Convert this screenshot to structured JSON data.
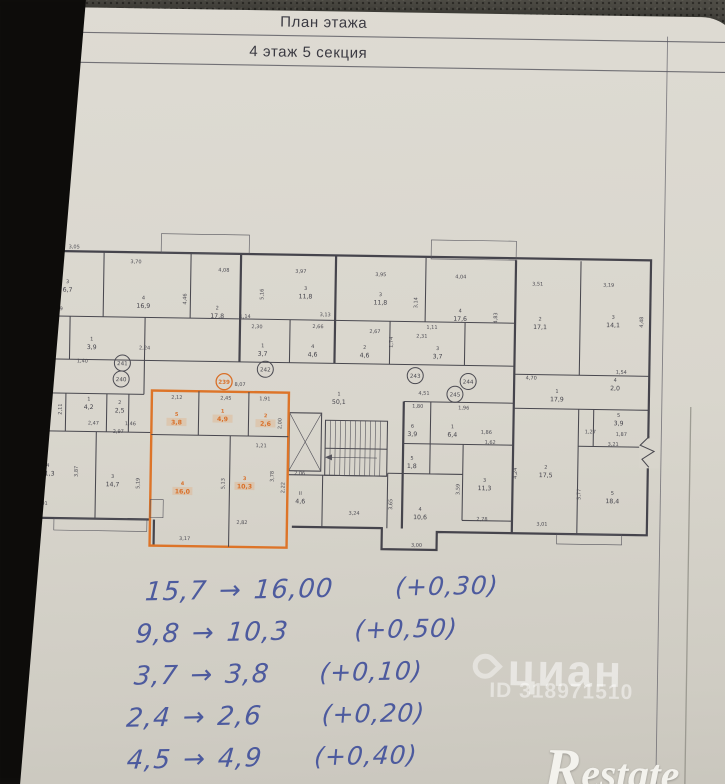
{
  "title_block": {
    "line1": "План этажа",
    "line2": "4 этаж 5 секция"
  },
  "plan": {
    "colors": {
      "highlight": "#dd7428",
      "ink": "#45444c",
      "paper": "#d9d6cd"
    },
    "rooms": [
      {
        "num": "3",
        "area": "6,7",
        "x": 72,
        "y": 284
      },
      {
        "num": "4",
        "area": "16,9",
        "x": 148,
        "y": 299
      },
      {
        "num": "2",
        "area": "17,8",
        "x": 222,
        "y": 308
      },
      {
        "num": "3",
        "area": "11,8",
        "x": 310,
        "y": 287
      },
      {
        "num": "3",
        "area": "11,8",
        "x": 385,
        "y": 292
      },
      {
        "num": "4",
        "area": "17,6",
        "x": 465,
        "y": 307
      },
      {
        "num": "2",
        "area": "17,1",
        "x": 545,
        "y": 314
      },
      {
        "num": "3",
        "area": "14,1",
        "x": 618,
        "y": 311
      },
      {
        "num": "2",
        "area": "3,3",
        "x": 57,
        "y": 345
      },
      {
        "num": "1",
        "area": "3,9",
        "x": 97,
        "y": 341
      },
      {
        "num": "1",
        "area": "3,7",
        "x": 268,
        "y": 345
      },
      {
        "num": "4",
        "area": "4,6",
        "x": 318,
        "y": 345
      },
      {
        "num": "2",
        "area": "4,6",
        "x": 370,
        "y": 345
      },
      {
        "num": "3",
        "area": "3,7",
        "x": 443,
        "y": 345
      },
      {
        "num": "1",
        "area": "50,1",
        "x": 345,
        "y": 392
      },
      {
        "num": "1",
        "area": "17,9",
        "x": 563,
        "y": 386
      },
      {
        "num": "5",
        "area": "3,9",
        "x": 52,
        "y": 404
      },
      {
        "num": "1",
        "area": "4,2",
        "x": 95,
        "y": 401
      },
      {
        "num": "2",
        "area": "2,5",
        "x": 126,
        "y": 404
      },
      {
        "num": "4",
        "area": "11,3",
        "x": 55,
        "y": 468
      },
      {
        "num": "3",
        "area": "14,7",
        "x": 120,
        "y": 478
      },
      {
        "num": "5",
        "area": "3,8",
        "x": 183,
        "y": 415,
        "hl": true
      },
      {
        "num": "1",
        "area": "4,9",
        "x": 229,
        "y": 411,
        "hl": true
      },
      {
        "num": "2",
        "area": "2,6",
        "x": 272,
        "y": 415,
        "hl": true
      },
      {
        "num": "4",
        "area": "16,0",
        "x": 190,
        "y": 484,
        "hl": true
      },
      {
        "num": "3",
        "area": "10,3",
        "x": 252,
        "y": 478,
        "hl": true
      },
      {
        "num": "II",
        "area": "4,6",
        "x": 308,
        "y": 492
      },
      {
        "num": "6",
        "area": "3,9",
        "x": 419,
        "y": 423
      },
      {
        "num": "1",
        "area": "6,4",
        "x": 459,
        "y": 423
      },
      {
        "num": "5",
        "area": "1,8",
        "x": 419,
        "y": 455
      },
      {
        "num": "4",
        "area": "10,6",
        "x": 428,
        "y": 506
      },
      {
        "num": "3",
        "area": "11,3",
        "x": 492,
        "y": 476
      },
      {
        "num": "2",
        "area": "17,5",
        "x": 553,
        "y": 462
      },
      {
        "num": "5",
        "area": "3,9",
        "x": 625,
        "y": 409
      },
      {
        "num": "4",
        "area": "2,0",
        "x": 621,
        "y": 374
      },
      {
        "num": "5",
        "area": "18,4",
        "x": 620,
        "y": 487
      }
    ],
    "dims": [
      {
        "t": "3,05",
        "x": 78,
        "y": 247
      },
      {
        "t": "3,70",
        "x": 140,
        "y": 261
      },
      {
        "t": "4,08",
        "x": 228,
        "y": 268
      },
      {
        "t": "3,97",
        "x": 305,
        "y": 268
      },
      {
        "t": "3,95",
        "x": 385,
        "y": 270
      },
      {
        "t": "4,04",
        "x": 465,
        "y": 271
      },
      {
        "t": "3,51",
        "x": 542,
        "y": 277
      },
      {
        "t": "3,19",
        "x": 613,
        "y": 277
      },
      {
        "t": "4,46",
        "x": 191,
        "y": 296,
        "r": true
      },
      {
        "t": "5,16",
        "x": 268,
        "y": 290,
        "r": true
      },
      {
        "t": "3,14",
        "x": 422,
        "y": 296,
        "r": true
      },
      {
        "t": "4,83",
        "x": 502,
        "y": 310,
        "r": true
      },
      {
        "t": "4,48",
        "x": 648,
        "y": 312,
        "r": true
      },
      {
        "t": "1,39",
        "x": 62,
        "y": 309
      },
      {
        "t": "3,13",
        "x": 330,
        "y": 311
      },
      {
        "t": "1,14",
        "x": 250,
        "y": 314
      },
      {
        "t": "2,30",
        "x": 262,
        "y": 324
      },
      {
        "t": "2,66",
        "x": 323,
        "y": 323
      },
      {
        "t": "2,67",
        "x": 380,
        "y": 327
      },
      {
        "t": "2,31",
        "x": 427,
        "y": 331
      },
      {
        "t": "1,11",
        "x": 437,
        "y": 322
      },
      {
        "t": "1,74",
        "x": 398,
        "y": 336,
        "r": true
      },
      {
        "t": "2,24",
        "x": 150,
        "y": 347
      },
      {
        "t": "1,61",
        "x": 52,
        "y": 371
      },
      {
        "t": "1,40",
        "x": 88,
        "y": 361
      },
      {
        "t": "1,98",
        "x": 50,
        "y": 422
      },
      {
        "t": "2,11",
        "x": 68,
        "y": 408,
        "r": true
      },
      {
        "t": "2,47",
        "x": 100,
        "y": 423
      },
      {
        "t": "1,46",
        "x": 137,
        "y": 423
      },
      {
        "t": "2,97",
        "x": 125,
        "y": 431
      },
      {
        "t": "3,87",
        "x": 85,
        "y": 470,
        "r": true
      },
      {
        "t": "5,19",
        "x": 147,
        "y": 481,
        "r": true
      },
      {
        "t": "3,01",
        "x": 50,
        "y": 504
      },
      {
        "t": "8,07",
        "x": 246,
        "y": 382
      },
      {
        "t": "2,12",
        "x": 183,
        "y": 396
      },
      {
        "t": "2,45",
        "x": 232,
        "y": 396
      },
      {
        "t": "1,91",
        "x": 271,
        "y": 396
      },
      {
        "t": "2,00",
        "x": 288,
        "y": 419,
        "r": true
      },
      {
        "t": "1,21",
        "x": 268,
        "y": 443
      },
      {
        "t": "5,13",
        "x": 232,
        "y": 480,
        "r": true
      },
      {
        "t": "3,78",
        "x": 281,
        "y": 472,
        "r": true
      },
      {
        "t": "2,22",
        "x": 292,
        "y": 483,
        "r": true
      },
      {
        "t": "3,17",
        "x": 193,
        "y": 537
      },
      {
        "t": "2,82",
        "x": 250,
        "y": 520
      },
      {
        "t": "2,06",
        "x": 307,
        "y": 470
      },
      {
        "t": "3,24",
        "x": 362,
        "y": 509
      },
      {
        "t": "4,51",
        "x": 430,
        "y": 388
      },
      {
        "t": "1,80",
        "x": 424,
        "y": 401
      },
      {
        "t": "1,96",
        "x": 470,
        "y": 402
      },
      {
        "t": "1,86",
        "x": 493,
        "y": 426
      },
      {
        "t": "1,62",
        "x": 497,
        "y": 436
      },
      {
        "t": "3,59",
        "x": 467,
        "y": 482,
        "r": true
      },
      {
        "t": "3,65",
        "x": 400,
        "y": 498,
        "r": true
      },
      {
        "t": "2,78",
        "x": 490,
        "y": 513
      },
      {
        "t": "3,00",
        "x": 425,
        "y": 540
      },
      {
        "t": "4,70",
        "x": 537,
        "y": 371
      },
      {
        "t": "1,54",
        "x": 627,
        "y": 364
      },
      {
        "t": "3,21",
        "x": 620,
        "y": 436
      },
      {
        "t": "1,27",
        "x": 597,
        "y": 424
      },
      {
        "t": "1,87",
        "x": 628,
        "y": 426
      },
      {
        "t": "5,77",
        "x": 588,
        "y": 485,
        "r": true
      },
      {
        "t": "4,24",
        "x": 524,
        "y": 465,
        "r": true
      },
      {
        "t": "3,01",
        "x": 550,
        "y": 517
      }
    ],
    "apartments": [
      {
        "num": "239",
        "x": 230,
        "y": 378,
        "hl": true
      },
      {
        "num": "241",
        "x": 128,
        "y": 361
      },
      {
        "num": "240",
        "x": 127,
        "y": 377
      },
      {
        "num": "242",
        "x": 271,
        "y": 365
      },
      {
        "num": "243",
        "x": 421,
        "y": 369
      },
      {
        "num": "244",
        "x": 474,
        "y": 374
      },
      {
        "num": "245",
        "x": 461,
        "y": 387
      }
    ]
  },
  "notes": {
    "rows": [
      {
        "from": "15,7",
        "arrow": "→",
        "to": "16,00",
        "delta": "(+0,30)"
      },
      {
        "from": "9,8",
        "arrow": "→",
        "to": "10,3",
        "delta": "(+0,50)"
      },
      {
        "from": "3,7",
        "arrow": "→",
        "to": "3,8",
        "delta": "(+0,10)"
      },
      {
        "from": "2,4",
        "arrow": "→",
        "to": "2,6",
        "delta": "(+0,20)"
      },
      {
        "from": "4,5",
        "arrow": "→",
        "to": "4,9",
        "delta": "(+0,40)"
      }
    ]
  },
  "watermarks": {
    "cian": "циан",
    "cian_id": "ID 318971510",
    "restate": "Restate"
  }
}
